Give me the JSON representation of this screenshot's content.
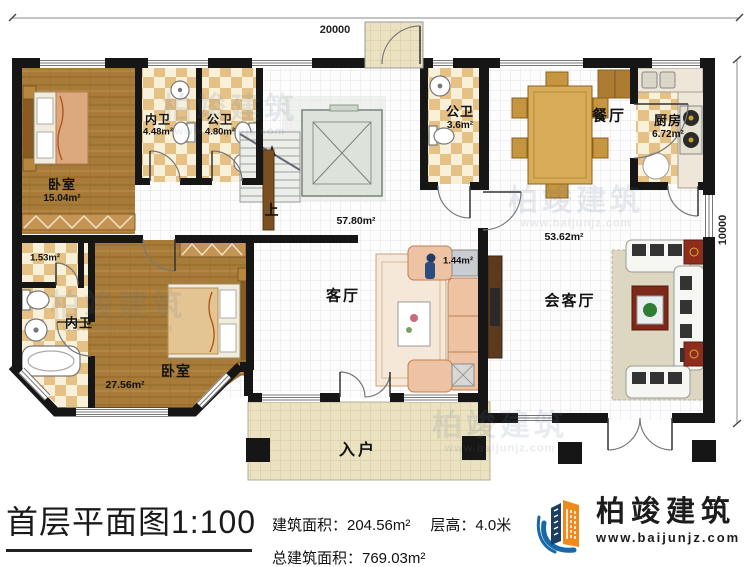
{
  "plan": {
    "dim_top": "20000",
    "dim_right": "10000",
    "rooms": {
      "bedroom1": {
        "name": "卧室",
        "area": "15.04m²"
      },
      "bath_inner1": {
        "name": "内卫",
        "area": "4.48m²"
      },
      "bath_public1": {
        "name": "公卫",
        "area": "4.80m²"
      },
      "bath_public2": {
        "name": "公卫",
        "area": "3.6m²"
      },
      "dining": {
        "name": "餐厅"
      },
      "kitchen": {
        "name": "厨房",
        "area": "6.72m²"
      },
      "living": {
        "name": "客厅"
      },
      "living_area": {
        "area": "57.80m²"
      },
      "reception": {
        "name": "会客厅"
      },
      "reception_area": {
        "area": "53.62m²"
      },
      "bedroom2": {
        "name": "卧室",
        "area": "27.56m²"
      },
      "bath_inner2": {
        "name": "内卫"
      },
      "closet": {
        "area": "1.53m²"
      },
      "niche": {
        "area": "1.44m²"
      },
      "stairs": {
        "name": "上"
      },
      "entrance": {
        "name": "入户"
      }
    }
  },
  "titlebar": {
    "title": "首层平面图1:100",
    "building_area": "建筑面积：204.56m²",
    "floor_height": "层高：4.0米",
    "total_area": "总建筑面积：769.03m²"
  },
  "logo": {
    "name": "柏竣建筑",
    "url": "www.baijunjz.com"
  },
  "watermark": {
    "text": "柏竣建筑",
    "url": "www.baijunjz.com"
  },
  "colors": {
    "wall": "#161616",
    "wood_floor": "#a87c38",
    "tile": "#e6c186",
    "porch": "#ebe2c2",
    "logo_blue": "#1668a8",
    "logo_orange": "#f08a1c"
  }
}
